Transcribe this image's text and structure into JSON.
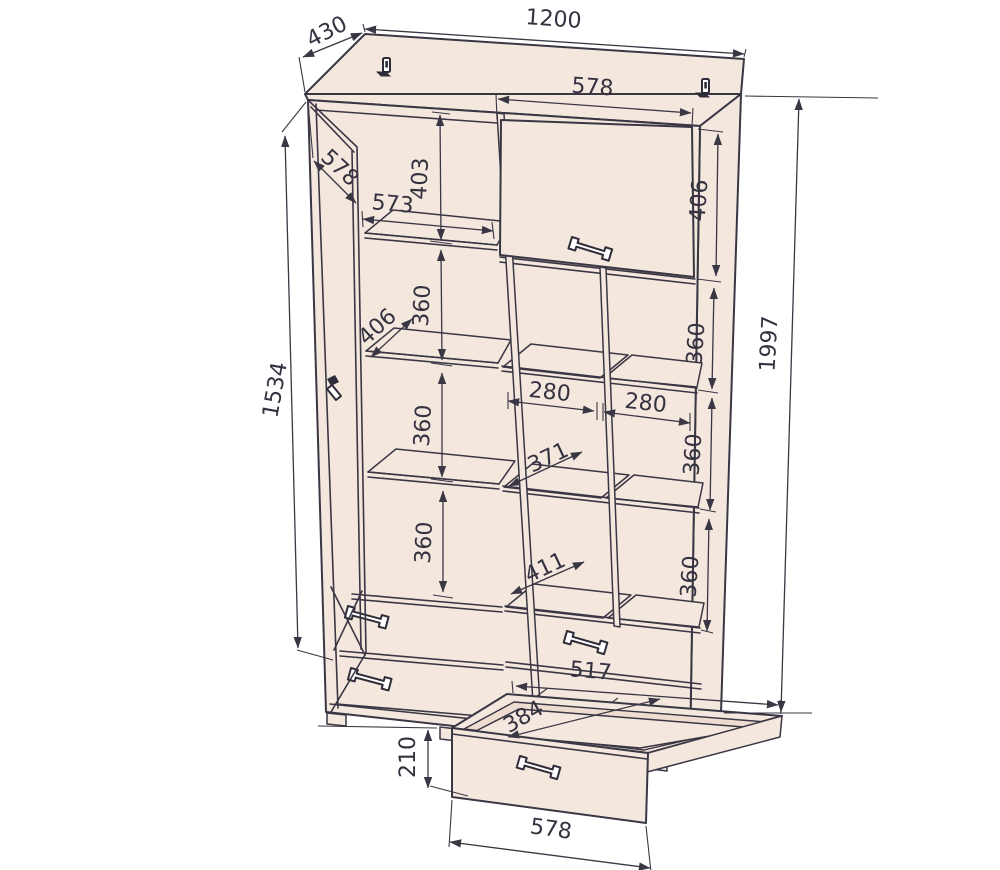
{
  "drawing_title": "wardrobe assembly dimension drawing",
  "style": {
    "panel_fill": "#f4e7de",
    "line_color": "#3a3744",
    "background": "#ffffff"
  },
  "cabinet": {
    "overall": {
      "width_mm": "1200",
      "depth_mm": "430",
      "height_mm": "1997"
    },
    "left_door": {
      "width_mm": "578",
      "height_mm": "1534"
    },
    "left_column": {
      "opening_width_mm": "573",
      "top_section_height_mm": "403",
      "shelf_depth_mm": "406",
      "section_heights_mm": [
        "360",
        "360",
        "360"
      ]
    },
    "right_door": {
      "width_mm": "578",
      "height_mm": "406"
    },
    "right_column": {
      "section_heights_mm": [
        "360",
        "360",
        "360"
      ],
      "cubby_widths_mm": [
        "280",
        "280"
      ],
      "mid_shelf_depth_mm": "371",
      "lower_shelf_depth_mm": "411"
    },
    "bottom_drawer": {
      "inner_width_mm": "517",
      "inner_depth_mm": "384",
      "front_height_mm": "210",
      "front_width_mm": "578"
    }
  }
}
